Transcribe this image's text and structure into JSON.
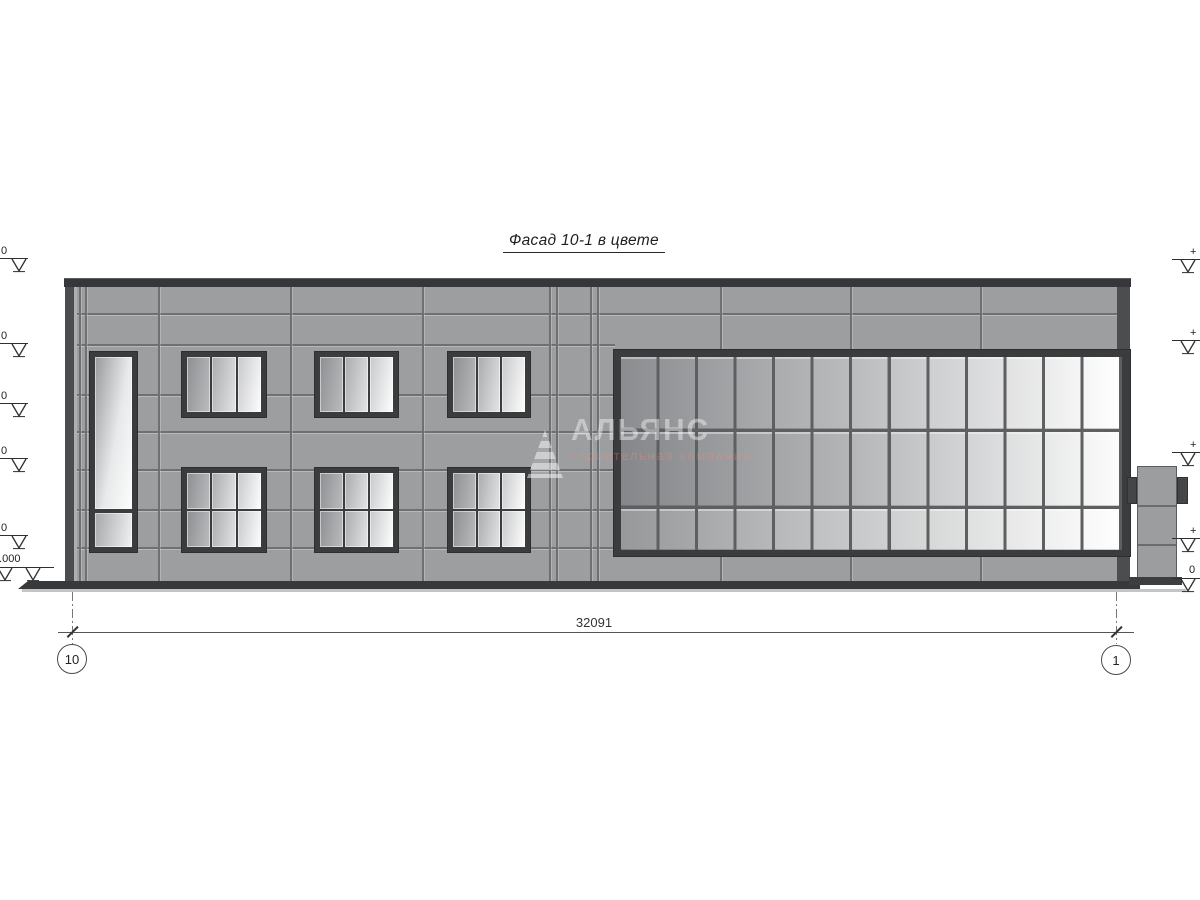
{
  "title": "Фасад 10-1 в цвете",
  "watermark": {
    "brand": "АЛЬЯНС",
    "tagline": "строительная компания"
  },
  "dimension": {
    "total_width": "32091"
  },
  "axis_bubbles": {
    "left": "10",
    "right": "1"
  },
  "elevations": {
    "left": [
      {
        "label": "0"
      },
      {
        "label": "0"
      },
      {
        "label": "0"
      },
      {
        "label": "0"
      },
      {
        "label": "0"
      },
      {
        "label": "1.000"
      }
    ],
    "right": [
      {
        "label": "+"
      },
      {
        "label": "+"
      },
      {
        "label": "+"
      },
      {
        "label": "+"
      },
      {
        "label": "0"
      }
    ]
  },
  "colors": {
    "wall": "#9c9ea0",
    "frame_dark": "#3a3c3e",
    "panel_joint": "#6e7072",
    "mullion": "#5d5f61",
    "plinth": "#37393b",
    "ground": "#c4c5c6",
    "glass_dark": "#85878a",
    "glass_light": "#ffffff",
    "line": "#2f2f2f"
  }
}
